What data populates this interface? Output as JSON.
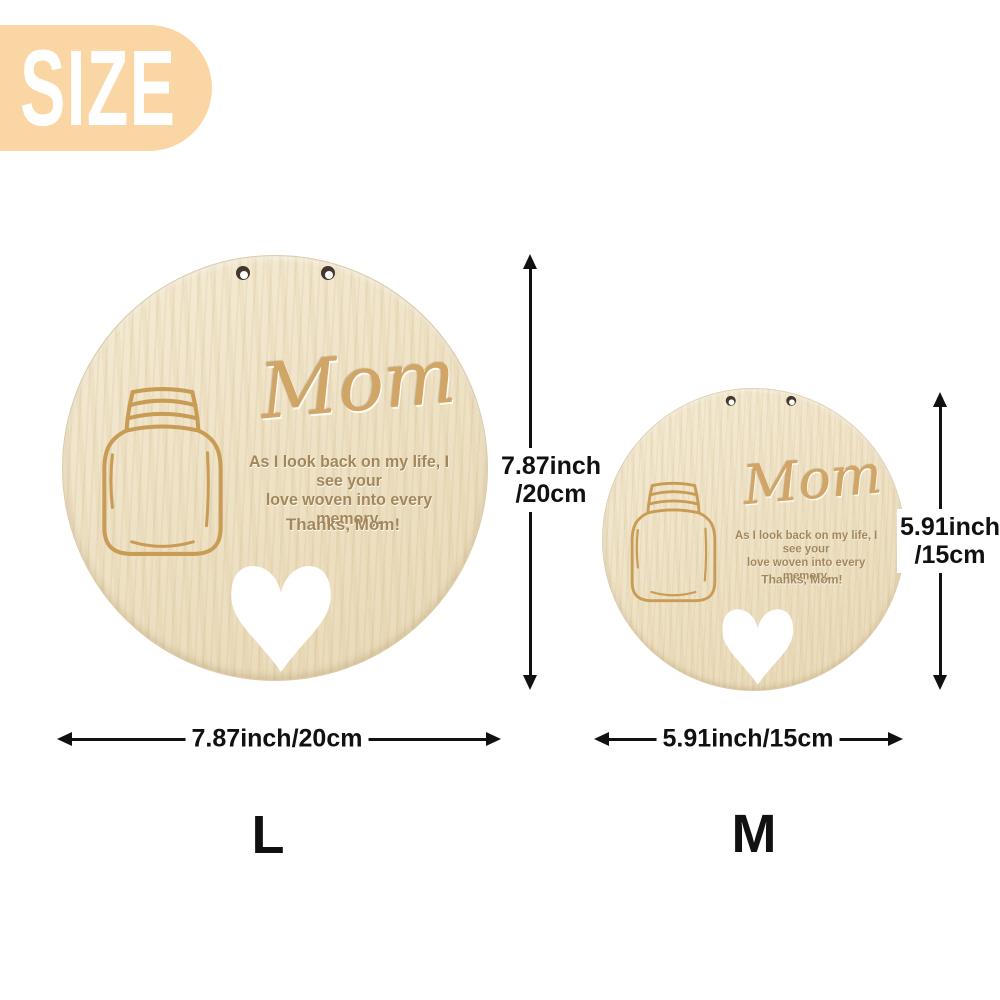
{
  "badge": {
    "label": "SIZE"
  },
  "plaque": {
    "title": "Mom",
    "quote_line1": "As I look back on my life, I see your",
    "quote_line2": "love woven into every memory.",
    "signature": "Thanks, Mom!"
  },
  "dimensions": {
    "large": {
      "size_label": "L",
      "height_line1": "7.87inch",
      "height_line2": "/20cm",
      "width_label": "7.87inch/20cm"
    },
    "medium": {
      "size_label": "M",
      "height_line1": "5.91inch",
      "height_line2": "/15cm",
      "width_label": "5.91inch/15cm"
    }
  },
  "icons": {
    "jar": "mason-jar-icon",
    "heart": "heart-cutout-icon",
    "hole": "hanging-hole-icon"
  },
  "colors": {
    "badge_bg": "#F9D6A3",
    "badge_text": "#FFFFFF",
    "wood_base": "#EFE3C7",
    "engraved_text": "#A3875A",
    "title_engraving": "#D0A566",
    "jar_stroke": "#C89C55",
    "heart_cutout": "#FFFFFF",
    "arrow": "#111111",
    "background": "#FFFFFF"
  }
}
